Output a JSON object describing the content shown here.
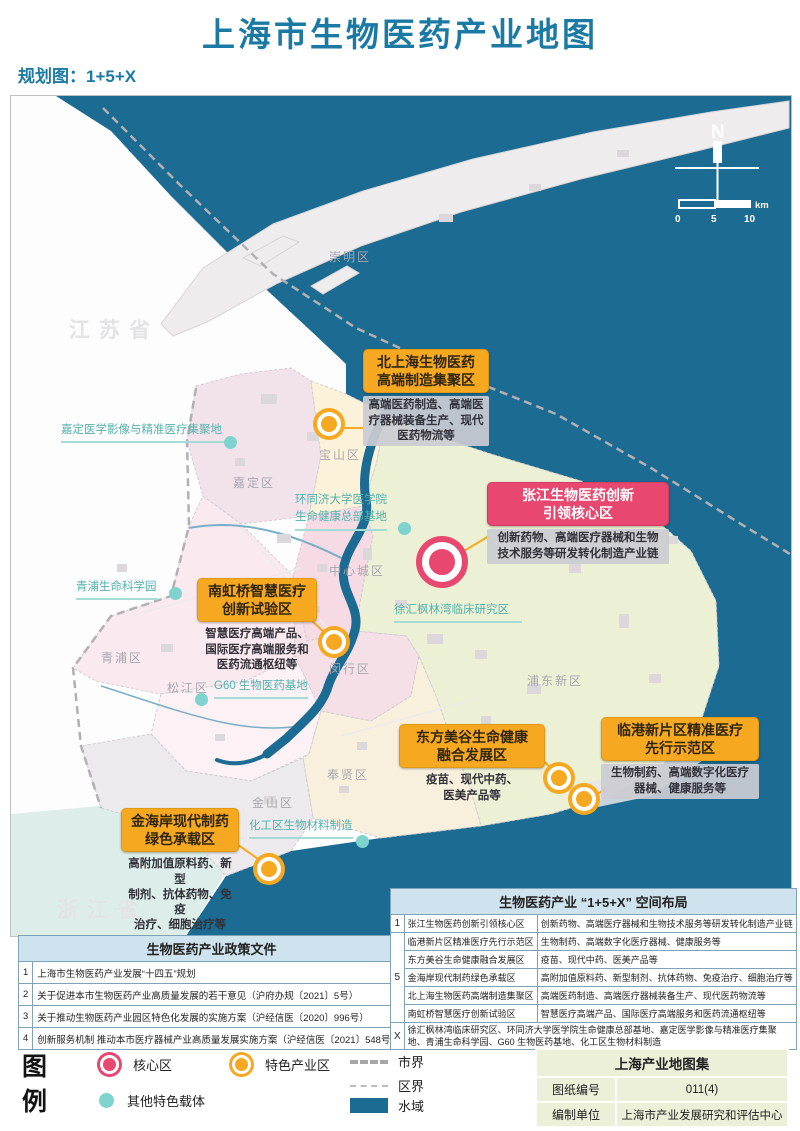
{
  "page": {
    "title": "上海市生物医药产业地图",
    "subtitle": "规划图：1+5+X"
  },
  "colors": {
    "title_teal": "#1b7aa3",
    "water": "#1c6b92",
    "core_pink": "#e8476f",
    "featured_orange": "#f5a820",
    "carrier_teal": "#7fd3ce"
  },
  "map": {
    "provinces": [
      "江苏省",
      "浙江省"
    ],
    "district_labels": [
      "崇明区",
      "嘉定区",
      "宝山区",
      "中心城区",
      "青浦区",
      "松江区",
      "闵行区",
      "浦东新区",
      "奉贤区",
      "金山区"
    ],
    "site_labels": [
      "嘉定医学影像与精准医疗集聚地",
      "环同济大学医学院\n生命健康总部基地",
      "青浦生命科学园",
      "G60 生物医药基地",
      "徐汇枫林湾临床研究区",
      "化工区生物材料制造"
    ],
    "callouts": [
      {
        "title": "北上海生物医药\n高端制造集聚区",
        "desc": "高端医药制造、高端医\n疗器械装备生产、现代\n医药物流等",
        "type": "featured"
      },
      {
        "title": "张江生物医药创新\n引领核心区",
        "desc": "创新药物、高端医疗器械和生物\n技术服务等研发转化制造产业链",
        "type": "core"
      },
      {
        "title": "南虹桥智慧医疗\n创新试验区",
        "desc": "智慧医疗高端产品、\n国际医疗高端服务和\n医药流通枢纽等",
        "type": "featured"
      },
      {
        "title": "东方美谷生命健康\n融合发展区",
        "desc": "疫苗、现代中药、\n医美产品等",
        "type": "featured"
      },
      {
        "title": "临港新片区精准医疗\n先行示范区",
        "desc": "生物制药、高端数字化医疗\n器械、健康服务等",
        "type": "featured"
      },
      {
        "title": "金海岸现代制药\n绿色承载区",
        "desc": "高附加值原料药、新型\n制剂、抗体药物、免疫\n治疗、细胞治疗等",
        "type": "featured"
      }
    ],
    "compass": {
      "north": "N",
      "tick0": "0",
      "tick1": "5",
      "tick2": "10",
      "unit": "km"
    }
  },
  "policy_table": {
    "title": "生物医药产业政策文件",
    "rows": [
      {
        "no": "1",
        "text": "上海市生物医药产业发展“十四五”规划"
      },
      {
        "no": "2",
        "text": "关于促进本市生物医药产业高质量发展的若干意见（沪府办规〔2021〕5号）"
      },
      {
        "no": "3",
        "text": "关于推动生物医药产业园区特色化发展的实施方案（沪经信医〔2020〕996号）"
      },
      {
        "no": "4",
        "text": "创新服务机制 推动本市医疗器械产业高质量发展实施方案（沪经信医〔2021〕548号）"
      }
    ]
  },
  "layout_table": {
    "title": "生物医药产业 “1+5+X” 空间布局",
    "groups": [
      {
        "no": "1",
        "rows": [
          {
            "name": "张江生物医药创新引领核心区",
            "desc": "创新药物、高端医疗器械和生物技术服务等研发转化制造产业链"
          }
        ]
      },
      {
        "no": "5",
        "rows": [
          {
            "name": "临港新片区精准医疗先行示范区",
            "desc": "生物制药、高端数字化医疗器械、健康服务等"
          },
          {
            "name": "东方美谷生命健康融合发展区",
            "desc": "疫苗、现代中药、医美产品等"
          },
          {
            "name": "金海岸现代制药绿色承载区",
            "desc": "高附加值原料药、新型制剂、抗体药物、免疫治疗、细胞治疗等"
          },
          {
            "name": "北上海生物医药高端制造集聚区",
            "desc": "高端医药制造、高端医疗器械装备生产、现代医药物流等"
          },
          {
            "name": "南虹桥智慧医疗创新试验区",
            "desc": "智慧医疗高端产品、国际医疗高端服务和医药流通枢纽等"
          }
        ]
      },
      {
        "no": "X",
        "rows": [
          {
            "name": "",
            "desc": "徐汇枫林湾临床研究区、环同济大学医学院生命健康总部基地、嘉定医学影像与精准医疗集聚地、青浦生命科学园、G60 生物医药基地、化工区生物材料制造"
          }
        ]
      }
    ]
  },
  "legend": {
    "title": "图例",
    "core": "核心区",
    "featured": "特色产业区",
    "carrier": "其他特色载体",
    "city_boundary": "市界",
    "district_boundary": "区界",
    "water": "水域"
  },
  "info_box": {
    "title": "上海产业地图集",
    "rows": [
      {
        "label": "图纸编号",
        "value": "011(4)"
      },
      {
        "label": "编制单位",
        "value": "上海市产业发展研究和评估中心"
      }
    ]
  }
}
